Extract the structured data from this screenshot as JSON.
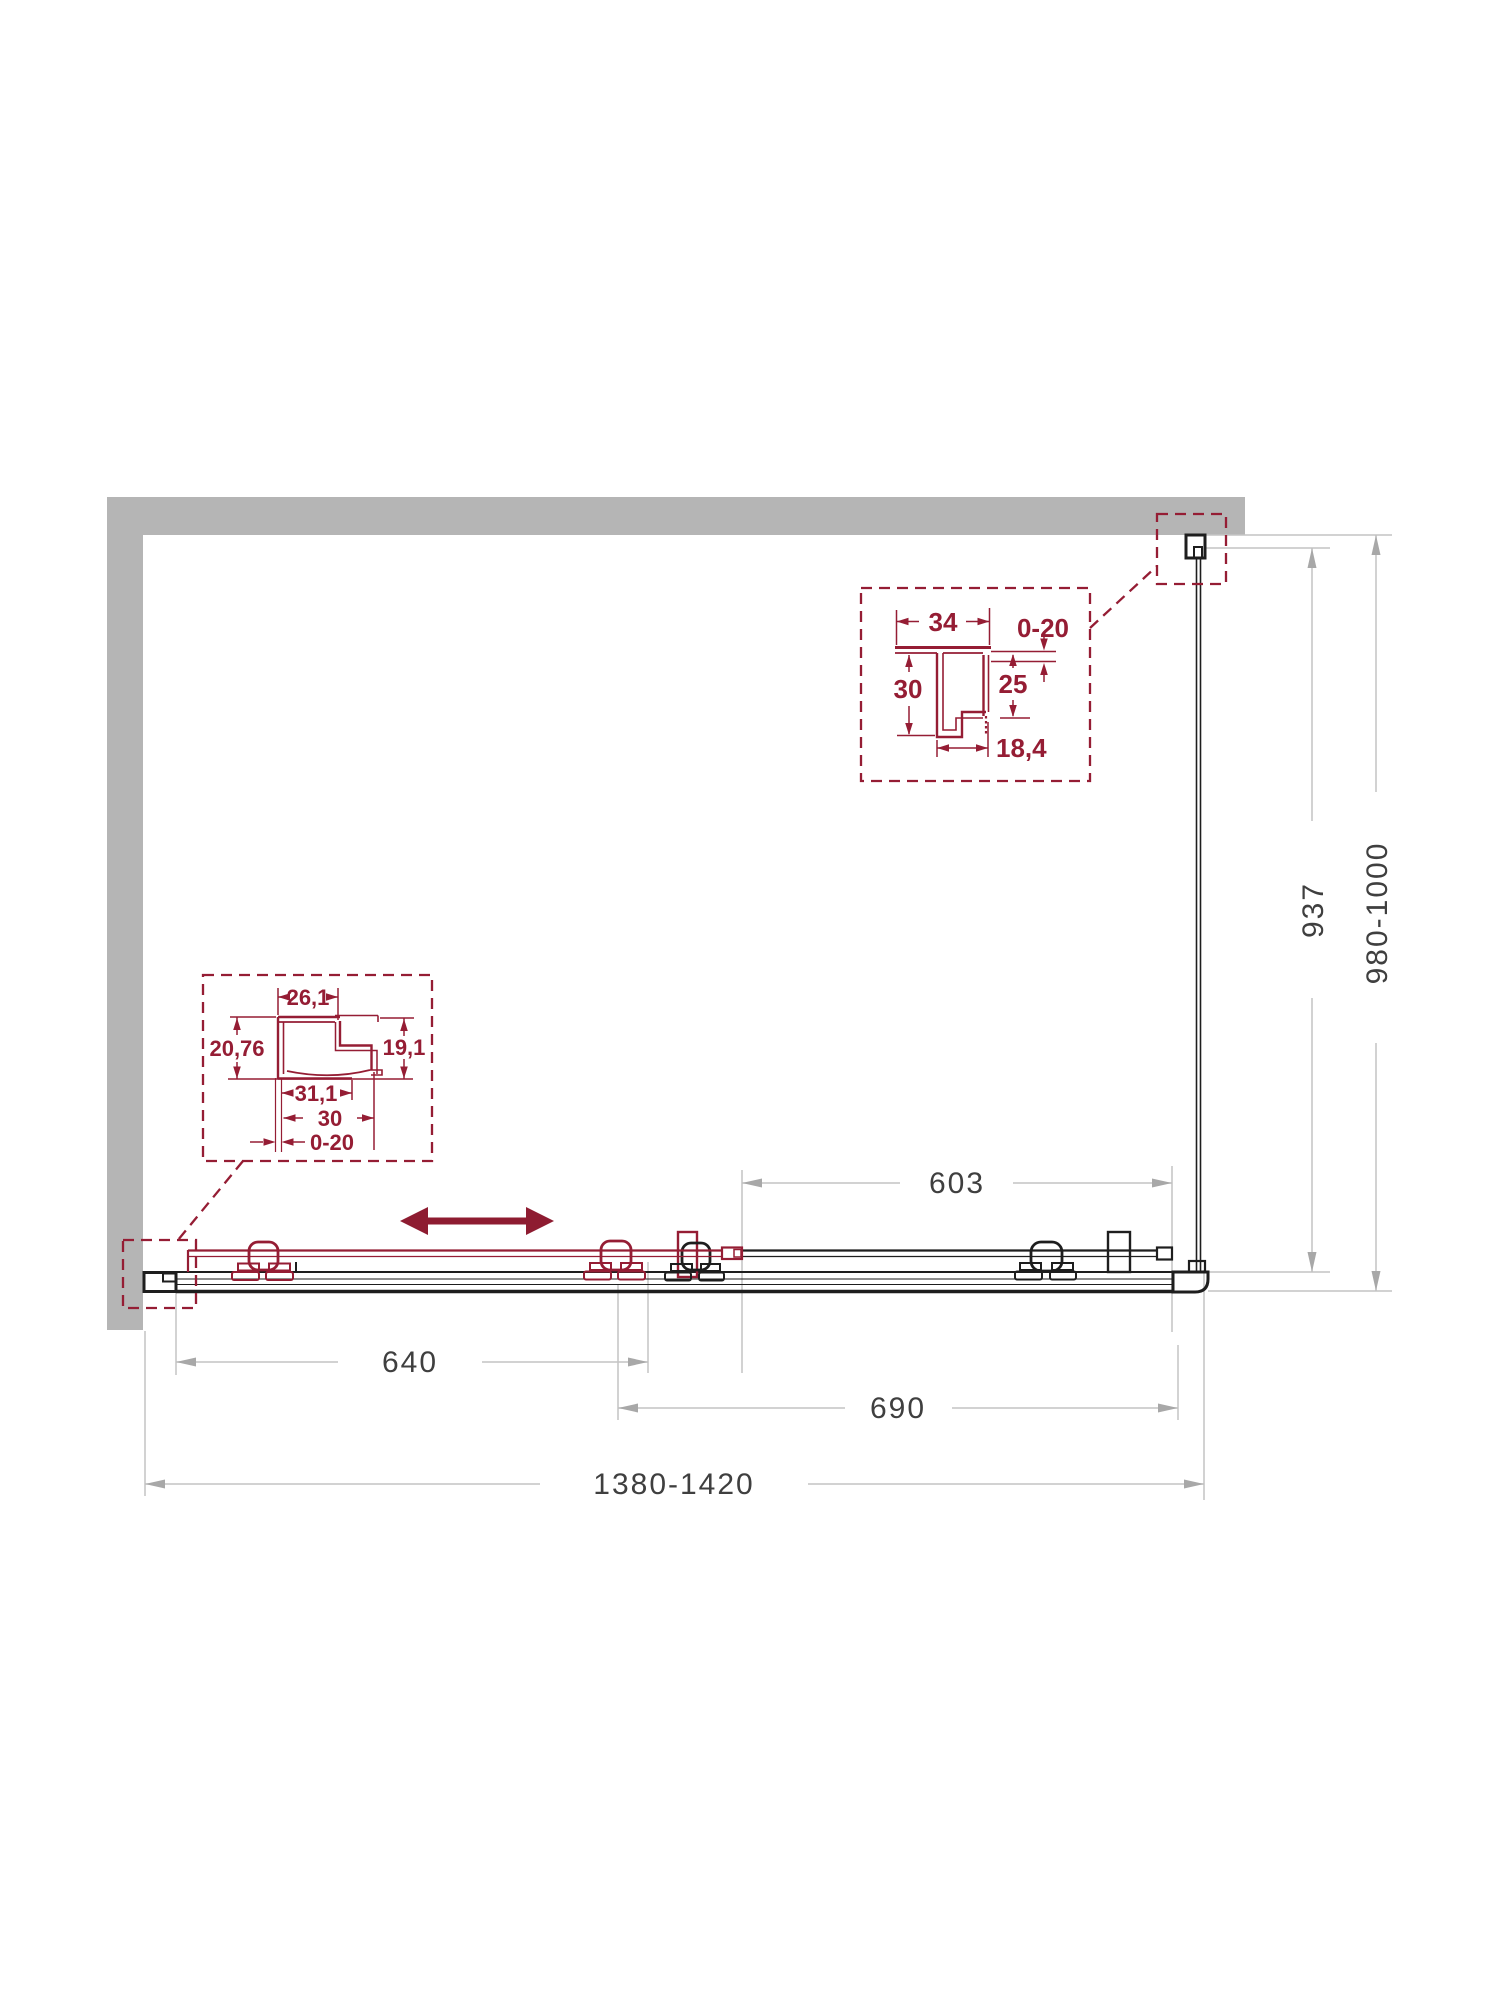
{
  "diagram": {
    "type": "shower-enclosure-installation-drawing",
    "colors": {
      "wall_gray": "#b5b5b5",
      "outline_black": "#1e1e1e",
      "accent_red": "#951d34",
      "dim_line_gray": "#c4c4c4",
      "dim_text": "#3f3f3f"
    },
    "dims": {
      "fixed_glass_width": "603",
      "door_width": "640",
      "opening_width": "690",
      "overall_width": "1380-1420",
      "side_glass_depth": "937",
      "side_overall_depth": "980-1000"
    },
    "detail_top_right": {
      "flange_width": "34",
      "wall_gap": "0-20",
      "profile_height": "30",
      "inner_depth": "25",
      "channel_width": "18,4"
    },
    "detail_bottom_left": {
      "top_width": "26,1",
      "left_height": "20,76",
      "right_height": "19,1",
      "inner_width": "31,1",
      "base_width": "30",
      "wall_gap": "0-20"
    }
  }
}
